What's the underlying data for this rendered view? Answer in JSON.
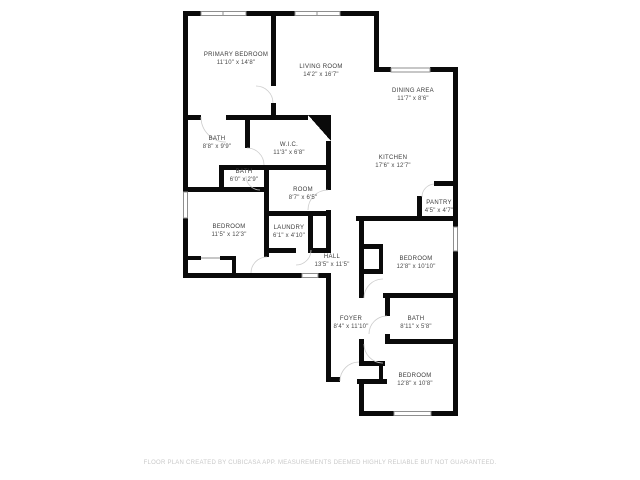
{
  "floor_plan": {
    "rooms": [
      {
        "id": "primary-bedroom",
        "name": "PRIMARY BEDROOM",
        "dims": "11'10\" x 14'8\""
      },
      {
        "id": "living-room",
        "name": "LIVING ROOM",
        "dims": "14'2\" x 16'7\""
      },
      {
        "id": "dining-area",
        "name": "DINING AREA",
        "dims": "11'7\" x 8'6\""
      },
      {
        "id": "kitchen",
        "name": "KITCHEN",
        "dims": "17'6\" x 12'7\""
      },
      {
        "id": "bath-main",
        "name": "BATH",
        "dims": "8'8\" x 9'9\""
      },
      {
        "id": "walk-in-closet",
        "name": "W.I.C.",
        "dims": "11'3\" x 6'8\""
      },
      {
        "id": "bath-small",
        "name": "BATH",
        "dims": "6'0\" x 2'9\""
      },
      {
        "id": "room",
        "name": "ROOM",
        "dims": "8'7\" x 6'5\""
      },
      {
        "id": "bedroom-left",
        "name": "BEDROOM",
        "dims": "11'5\" x 12'3\""
      },
      {
        "id": "laundry",
        "name": "LAUNDRY",
        "dims": "6'1\" x 4'10\""
      },
      {
        "id": "hall",
        "name": "HALL",
        "dims": "13'5\" x 11'5\""
      },
      {
        "id": "pantry",
        "name": "PANTRY",
        "dims": "4'5\" x 4'7\""
      },
      {
        "id": "bedroom-middle",
        "name": "BEDROOM",
        "dims": "12'8\" x 10'10\""
      },
      {
        "id": "foyer",
        "name": "FOYER",
        "dims": "8'4\" x 11'10\""
      },
      {
        "id": "bath-middle",
        "name": "BATH",
        "dims": "8'11\" x 5'8\""
      },
      {
        "id": "bedroom-bottom",
        "name": "BEDROOM",
        "dims": "12'8\" x 10'8\""
      }
    ],
    "footer": "FLOOR PLAN CREATED BY CUBICASA APP. MEASUREMENTS DEEMED HIGHLY RELIABLE BUT NOT GUARANTEED.",
    "colors": {
      "wall": "#0a0a0a",
      "background": "#ffffff",
      "label": "#3b3b3b",
      "window_outline": "#8f8f8f",
      "door_arc": "#cccccc",
      "footer_text": "#c9c9c9"
    }
  }
}
